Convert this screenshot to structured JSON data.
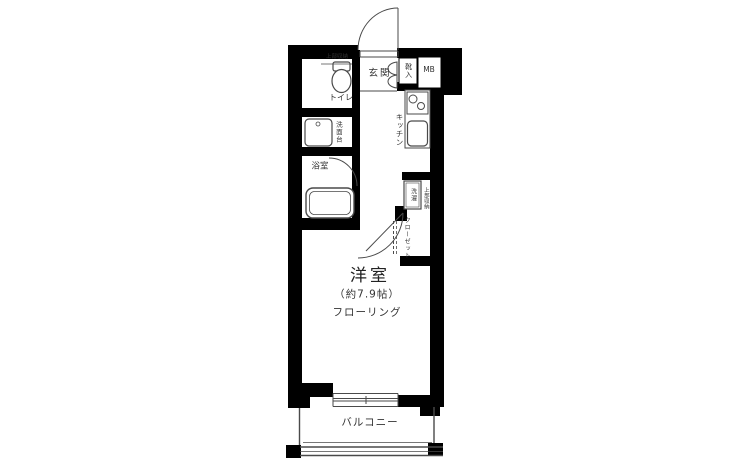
{
  "floorplan": {
    "labels": {
      "entrance": "玄関",
      "shoe_cabinet": "靴入",
      "meter_box": "MB",
      "toilet": "トイレ",
      "toilet_upper_storage": "上部収納",
      "washstand": "洗面台",
      "bathroom": "浴室",
      "kitchen": "キッチン",
      "laundry": "洗濯",
      "laundry_upper_storage": "上部収納",
      "closet": "クローゼット",
      "room": "洋室",
      "room_size": "（約7.9帖）",
      "room_flooring": "フローリング",
      "balcony": "バルコニー"
    },
    "colors": {
      "wall": "#000000",
      "fixture_line": "#4a4a4a",
      "text": "#333333",
      "background": "#ffffff"
    }
  }
}
